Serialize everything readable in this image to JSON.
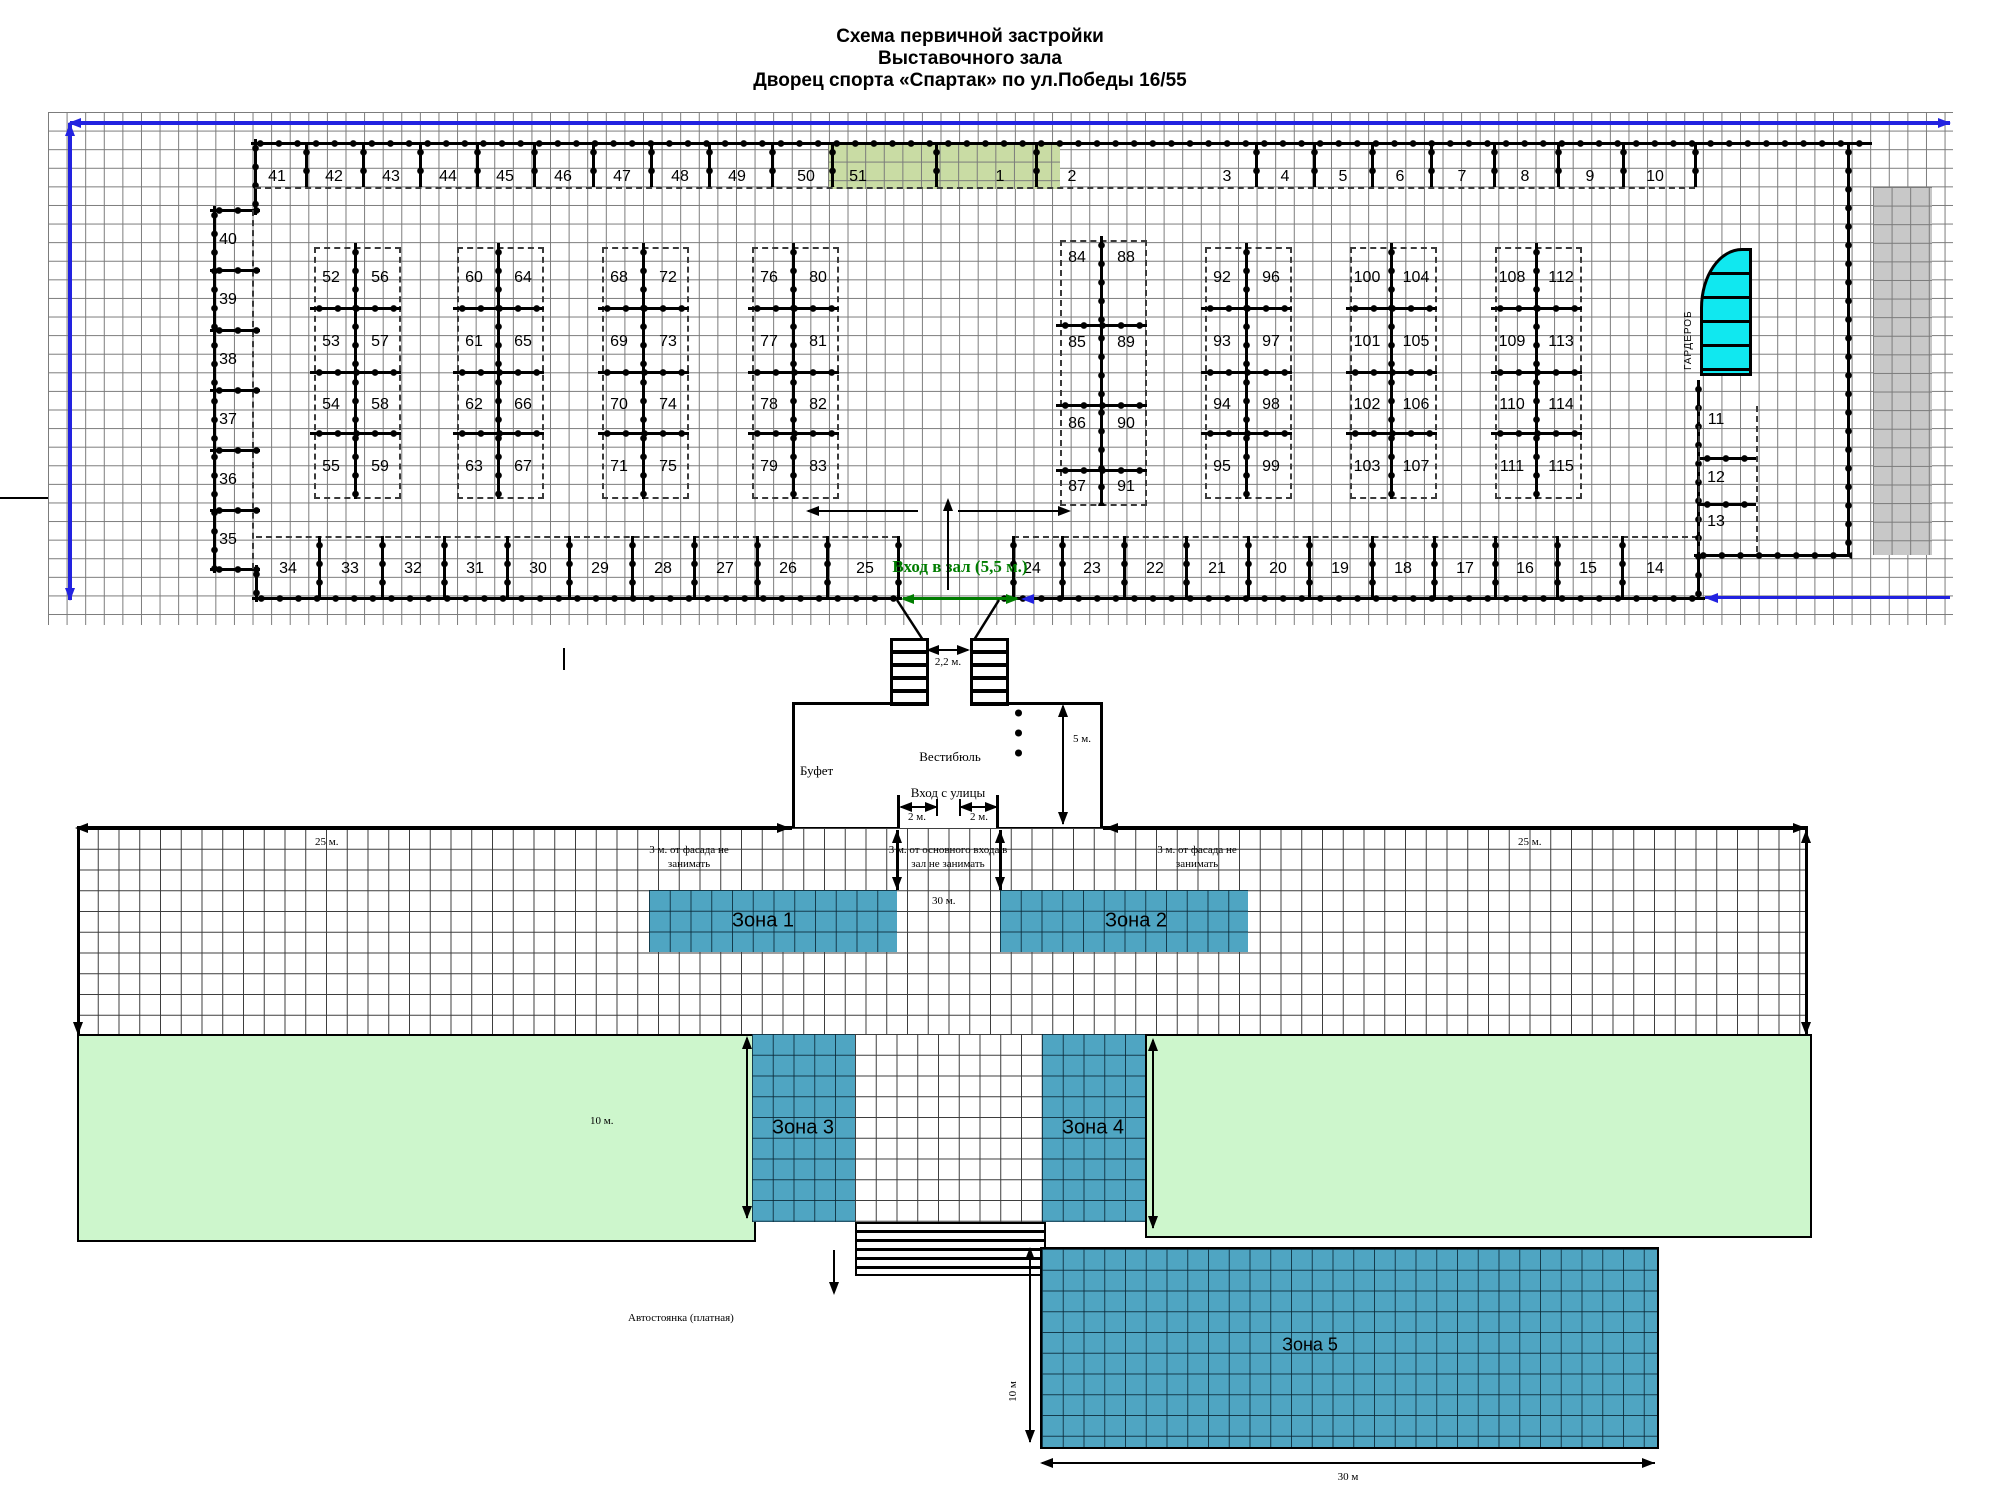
{
  "title": {
    "l1": "Схема первичной застройки",
    "l2": "Выставочного зала",
    "l3": "Дворец спорта «Спартак» по ул.Победы  16/55"
  },
  "hall": {
    "entrance_label": "Вход в зал (5,5 м.)",
    "cloakroom_label": "ГАРДЕРОБ",
    "top_row": [
      {
        "n": "41",
        "x": 277
      },
      {
        "n": "42",
        "x": 334
      },
      {
        "n": "43",
        "x": 391
      },
      {
        "n": "44",
        "x": 448
      },
      {
        "n": "45",
        "x": 505
      },
      {
        "n": "46",
        "x": 563
      },
      {
        "n": "47",
        "x": 622
      },
      {
        "n": "48",
        "x": 680
      },
      {
        "n": "49",
        "x": 737
      },
      {
        "n": "50",
        "x": 806
      },
      {
        "n": "51",
        "x": 858
      },
      {
        "n": "1",
        "x": 1000
      },
      {
        "n": "2",
        "x": 1072
      },
      {
        "n": "3",
        "x": 1227
      },
      {
        "n": "4",
        "x": 1285
      },
      {
        "n": "5",
        "x": 1343
      },
      {
        "n": "6",
        "x": 1400
      },
      {
        "n": "7",
        "x": 1462
      },
      {
        "n": "8",
        "x": 1525
      },
      {
        "n": "9",
        "x": 1590
      },
      {
        "n": "10",
        "x": 1655
      }
    ],
    "bottom_row": [
      {
        "n": "34",
        "x": 288
      },
      {
        "n": "33",
        "x": 350
      },
      {
        "n": "32",
        "x": 413
      },
      {
        "n": "31",
        "x": 475
      },
      {
        "n": "30",
        "x": 538
      },
      {
        "n": "29",
        "x": 600
      },
      {
        "n": "28",
        "x": 663
      },
      {
        "n": "27",
        "x": 725
      },
      {
        "n": "26",
        "x": 788
      },
      {
        "n": "25",
        "x": 865
      },
      {
        "n": "24",
        "x": 1032
      },
      {
        "n": "23",
        "x": 1092
      },
      {
        "n": "22",
        "x": 1155
      },
      {
        "n": "21",
        "x": 1217
      },
      {
        "n": "20",
        "x": 1278
      },
      {
        "n": "19",
        "x": 1340
      },
      {
        "n": "18",
        "x": 1403
      },
      {
        "n": "17",
        "x": 1465
      },
      {
        "n": "16",
        "x": 1525
      },
      {
        "n": "15",
        "x": 1588
      },
      {
        "n": "14",
        "x": 1655
      }
    ],
    "left_col": [
      {
        "n": "40",
        "y": 240
      },
      {
        "n": "39",
        "y": 300
      },
      {
        "n": "38",
        "y": 360
      },
      {
        "n": "37",
        "y": 420
      },
      {
        "n": "36",
        "y": 480
      },
      {
        "n": "35",
        "y": 540
      }
    ],
    "right_col": [
      {
        "n": "11",
        "y": 420
      },
      {
        "n": "12",
        "y": 478
      },
      {
        "n": "13",
        "y": 522
      }
    ],
    "islands": [
      {
        "left": 314,
        "nums": [
          [
            "52",
            "56"
          ],
          [
            "53",
            "57"
          ],
          [
            "54",
            "58"
          ],
          [
            "55",
            "59"
          ]
        ]
      },
      {
        "left": 457,
        "nums": [
          [
            "60",
            "64"
          ],
          [
            "61",
            "65"
          ],
          [
            "62",
            "66"
          ],
          [
            "63",
            "67"
          ]
        ]
      },
      {
        "left": 602,
        "nums": [
          [
            "68",
            "72"
          ],
          [
            "69",
            "73"
          ],
          [
            "70",
            "74"
          ],
          [
            "71",
            "75"
          ]
        ]
      },
      {
        "left": 752,
        "nums": [
          [
            "76",
            "80"
          ],
          [
            "77",
            "81"
          ],
          [
            "78",
            "82"
          ],
          [
            "79",
            "83"
          ]
        ]
      },
      {
        "left": 1060,
        "rows": [
          258,
          343,
          424,
          487
        ],
        "rungs": [
          325,
          405,
          470
        ],
        "rect": [
          240,
          502
        ],
        "nums": [
          [
            "84",
            "88"
          ],
          [
            "85",
            "89"
          ],
          [
            "86",
            "90"
          ],
          [
            "87",
            "91"
          ]
        ]
      },
      {
        "left": 1205,
        "nums": [
          [
            "92",
            "96"
          ],
          [
            "93",
            "97"
          ],
          [
            "94",
            "98"
          ],
          [
            "95",
            "99"
          ]
        ]
      },
      {
        "left": 1350,
        "nums": [
          [
            "100",
            "104"
          ],
          [
            "101",
            "105"
          ],
          [
            "102",
            "106"
          ],
          [
            "103",
            "107"
          ]
        ]
      },
      {
        "left": 1495,
        "nums": [
          [
            "108",
            "112"
          ],
          [
            "109",
            "113"
          ],
          [
            "110",
            "114"
          ],
          [
            "111",
            "115"
          ]
        ]
      }
    ]
  },
  "vestibule": {
    "hall_name": "Вестибюль",
    "buffet": "Буфет",
    "street_entrance": "Вход с улицы",
    "stair_gap": "2,2 м.",
    "dim_height": "5 м.",
    "dim_door_left": "2 м.",
    "dim_door_right": "2 м."
  },
  "outdoor": {
    "dim_25_left": "25 м.",
    "dim_25_right": "25 м.",
    "dim_30_center": "30 м.",
    "keepout_left_1": "3 м. от фасада не",
    "keepout_left_2": "занимать",
    "keepout_center_1": "3 м. от основного входа в",
    "keepout_center_2": "зал не занимать",
    "keepout_right_1": "3 м. от фасада не",
    "keepout_right_2": "занимать",
    "dim_10_left": "10 м.",
    "zone1": "Зона 1",
    "zone2": "Зона 2",
    "zone3": "Зона 3",
    "zone4": "Зона 4",
    "zone5": "Зона 5",
    "zone5_height": "10 м",
    "zone5_width": "30 м",
    "parking": "Автостоянка (платная)"
  },
  "colors": {
    "booth_green": "#c9dca4",
    "zone_teal": "#4fa5c2",
    "light_green": "#cdf6cc",
    "cyan": "#10e8f0",
    "gray_block": "#c8c8c8",
    "blue": "#2222e0",
    "green_text": "#007d00"
  }
}
